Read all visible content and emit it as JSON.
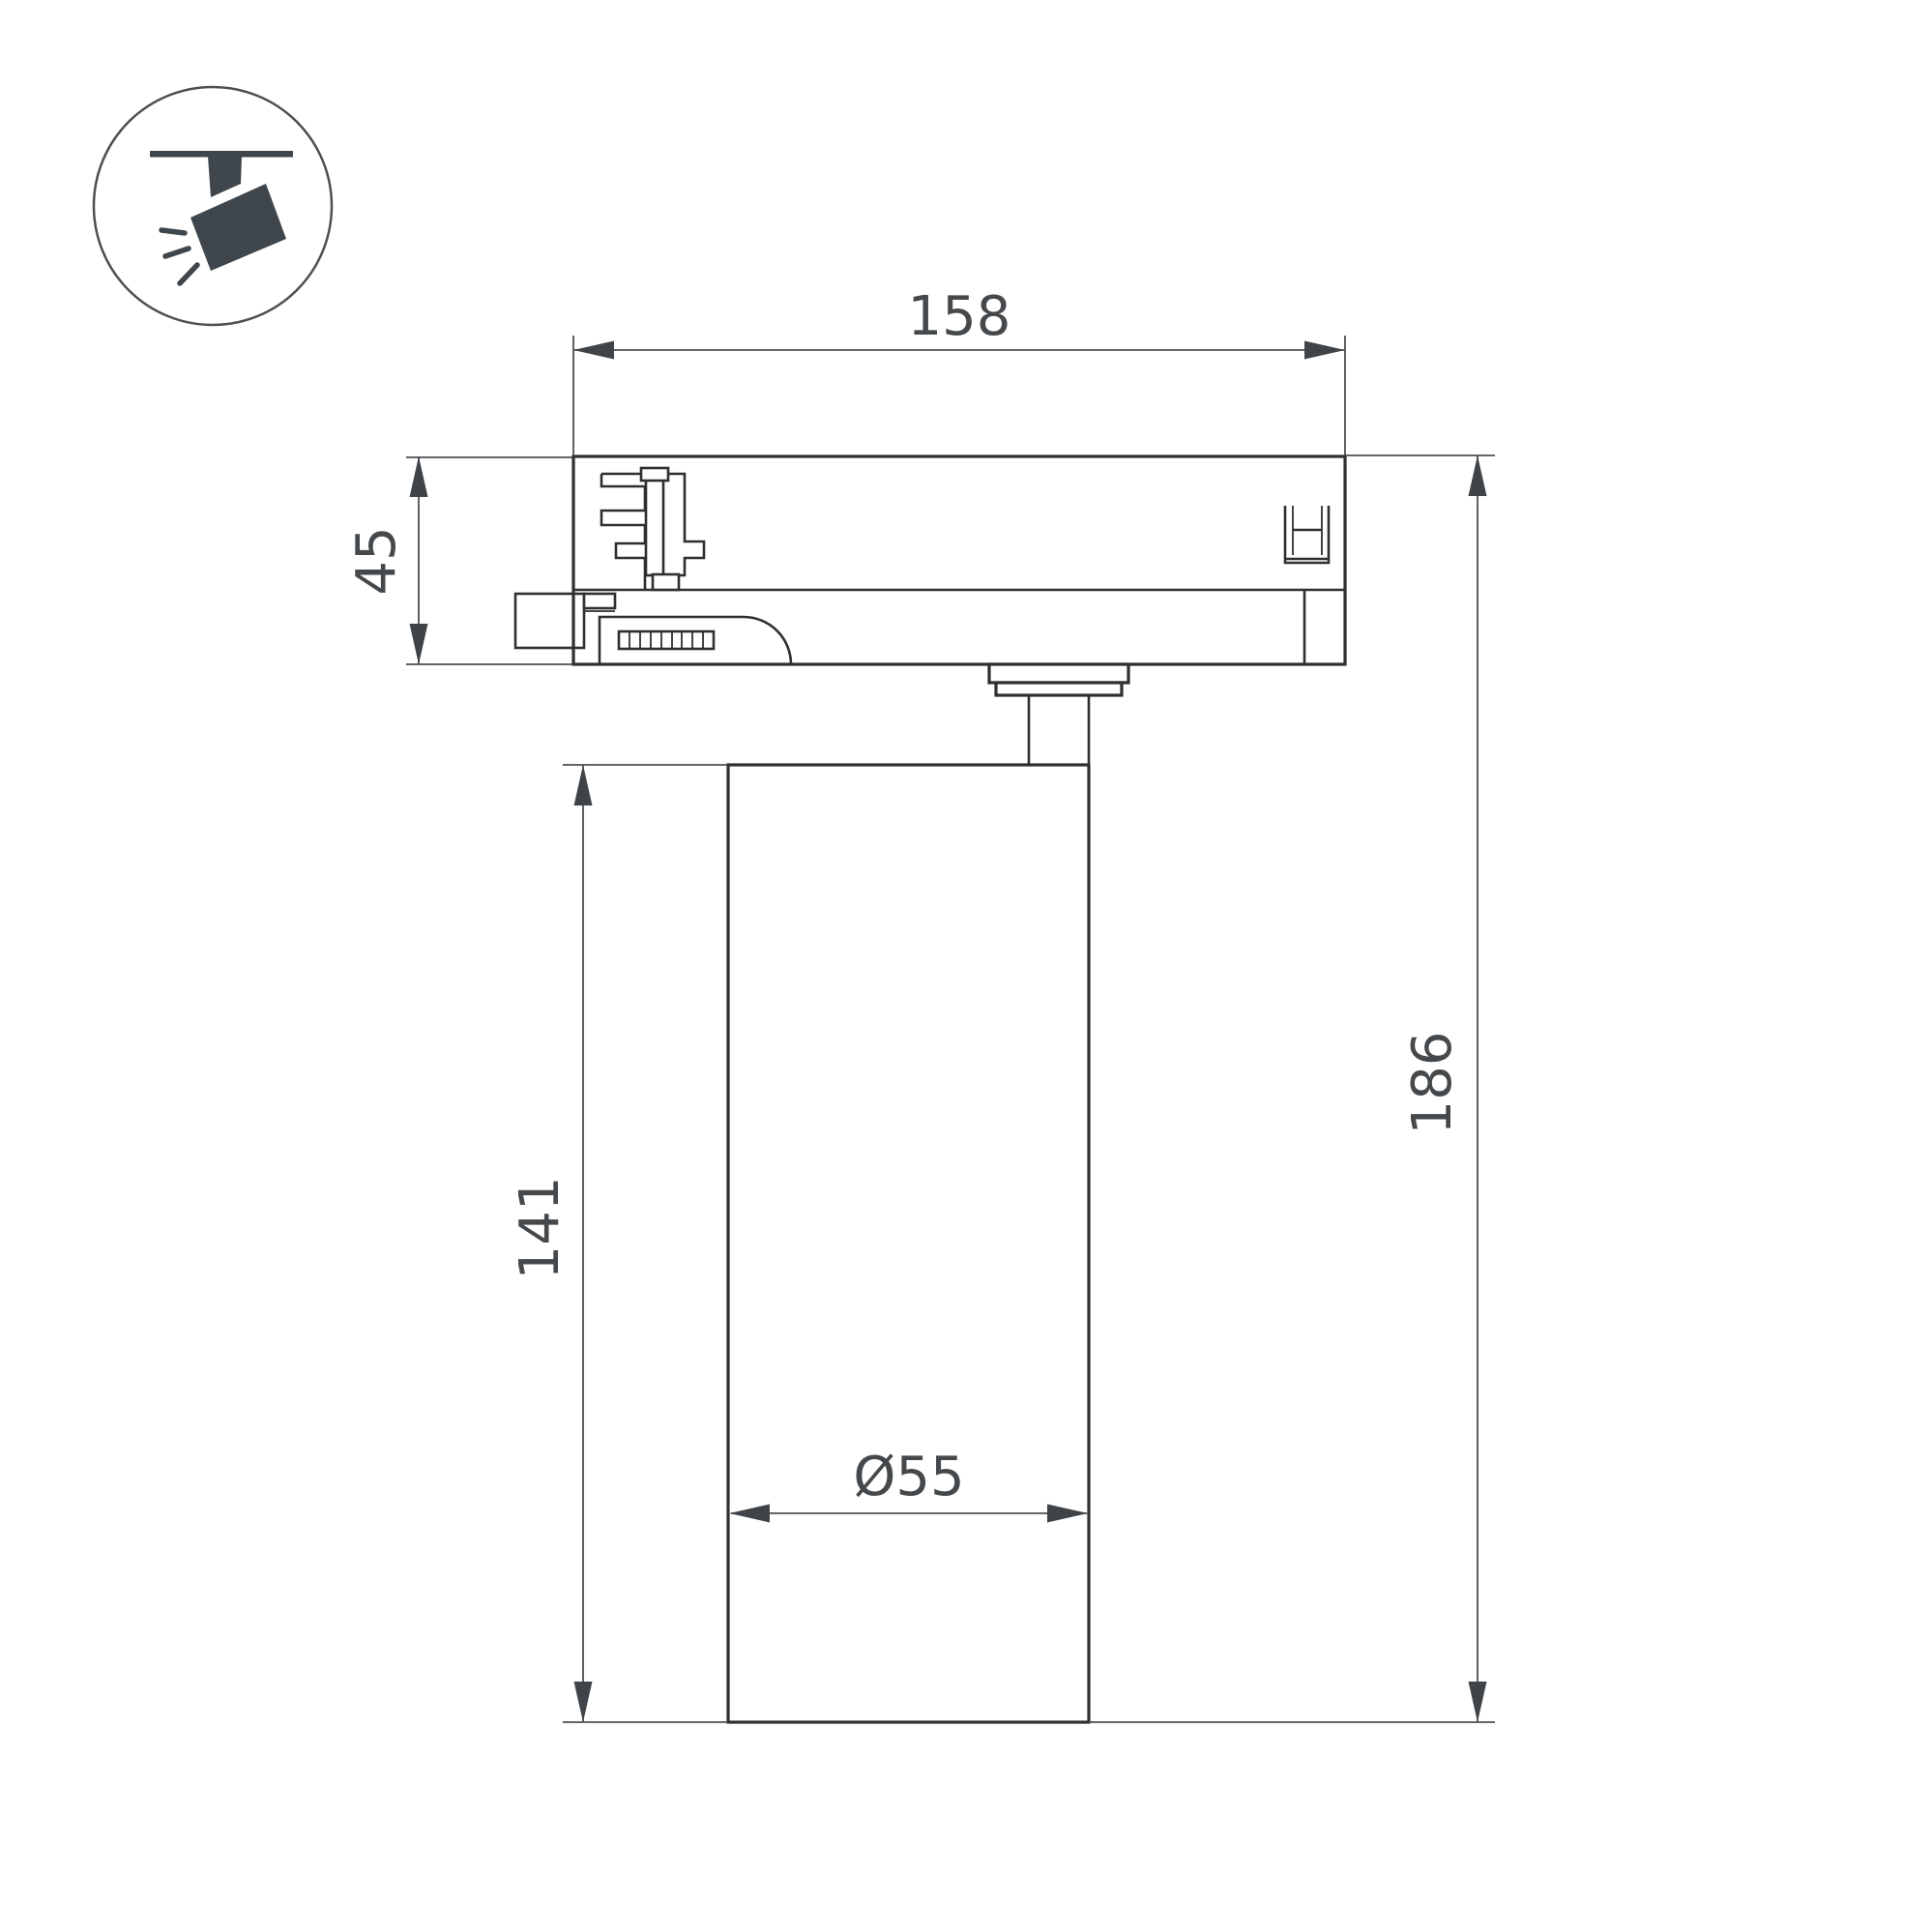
{
  "dimensions": {
    "adapter_width": "158",
    "adapter_height": "45",
    "body_height": "141",
    "overall_height": "186",
    "body_diameter": "Ø55"
  },
  "icon": {
    "name": "track-spotlight-icon"
  },
  "colors": {
    "outline": "#2d2f31",
    "dimension_line": "#4b5054",
    "dimension_text": "#45494c",
    "icon_fill": "#3f474c",
    "background": "#ffffff"
  }
}
